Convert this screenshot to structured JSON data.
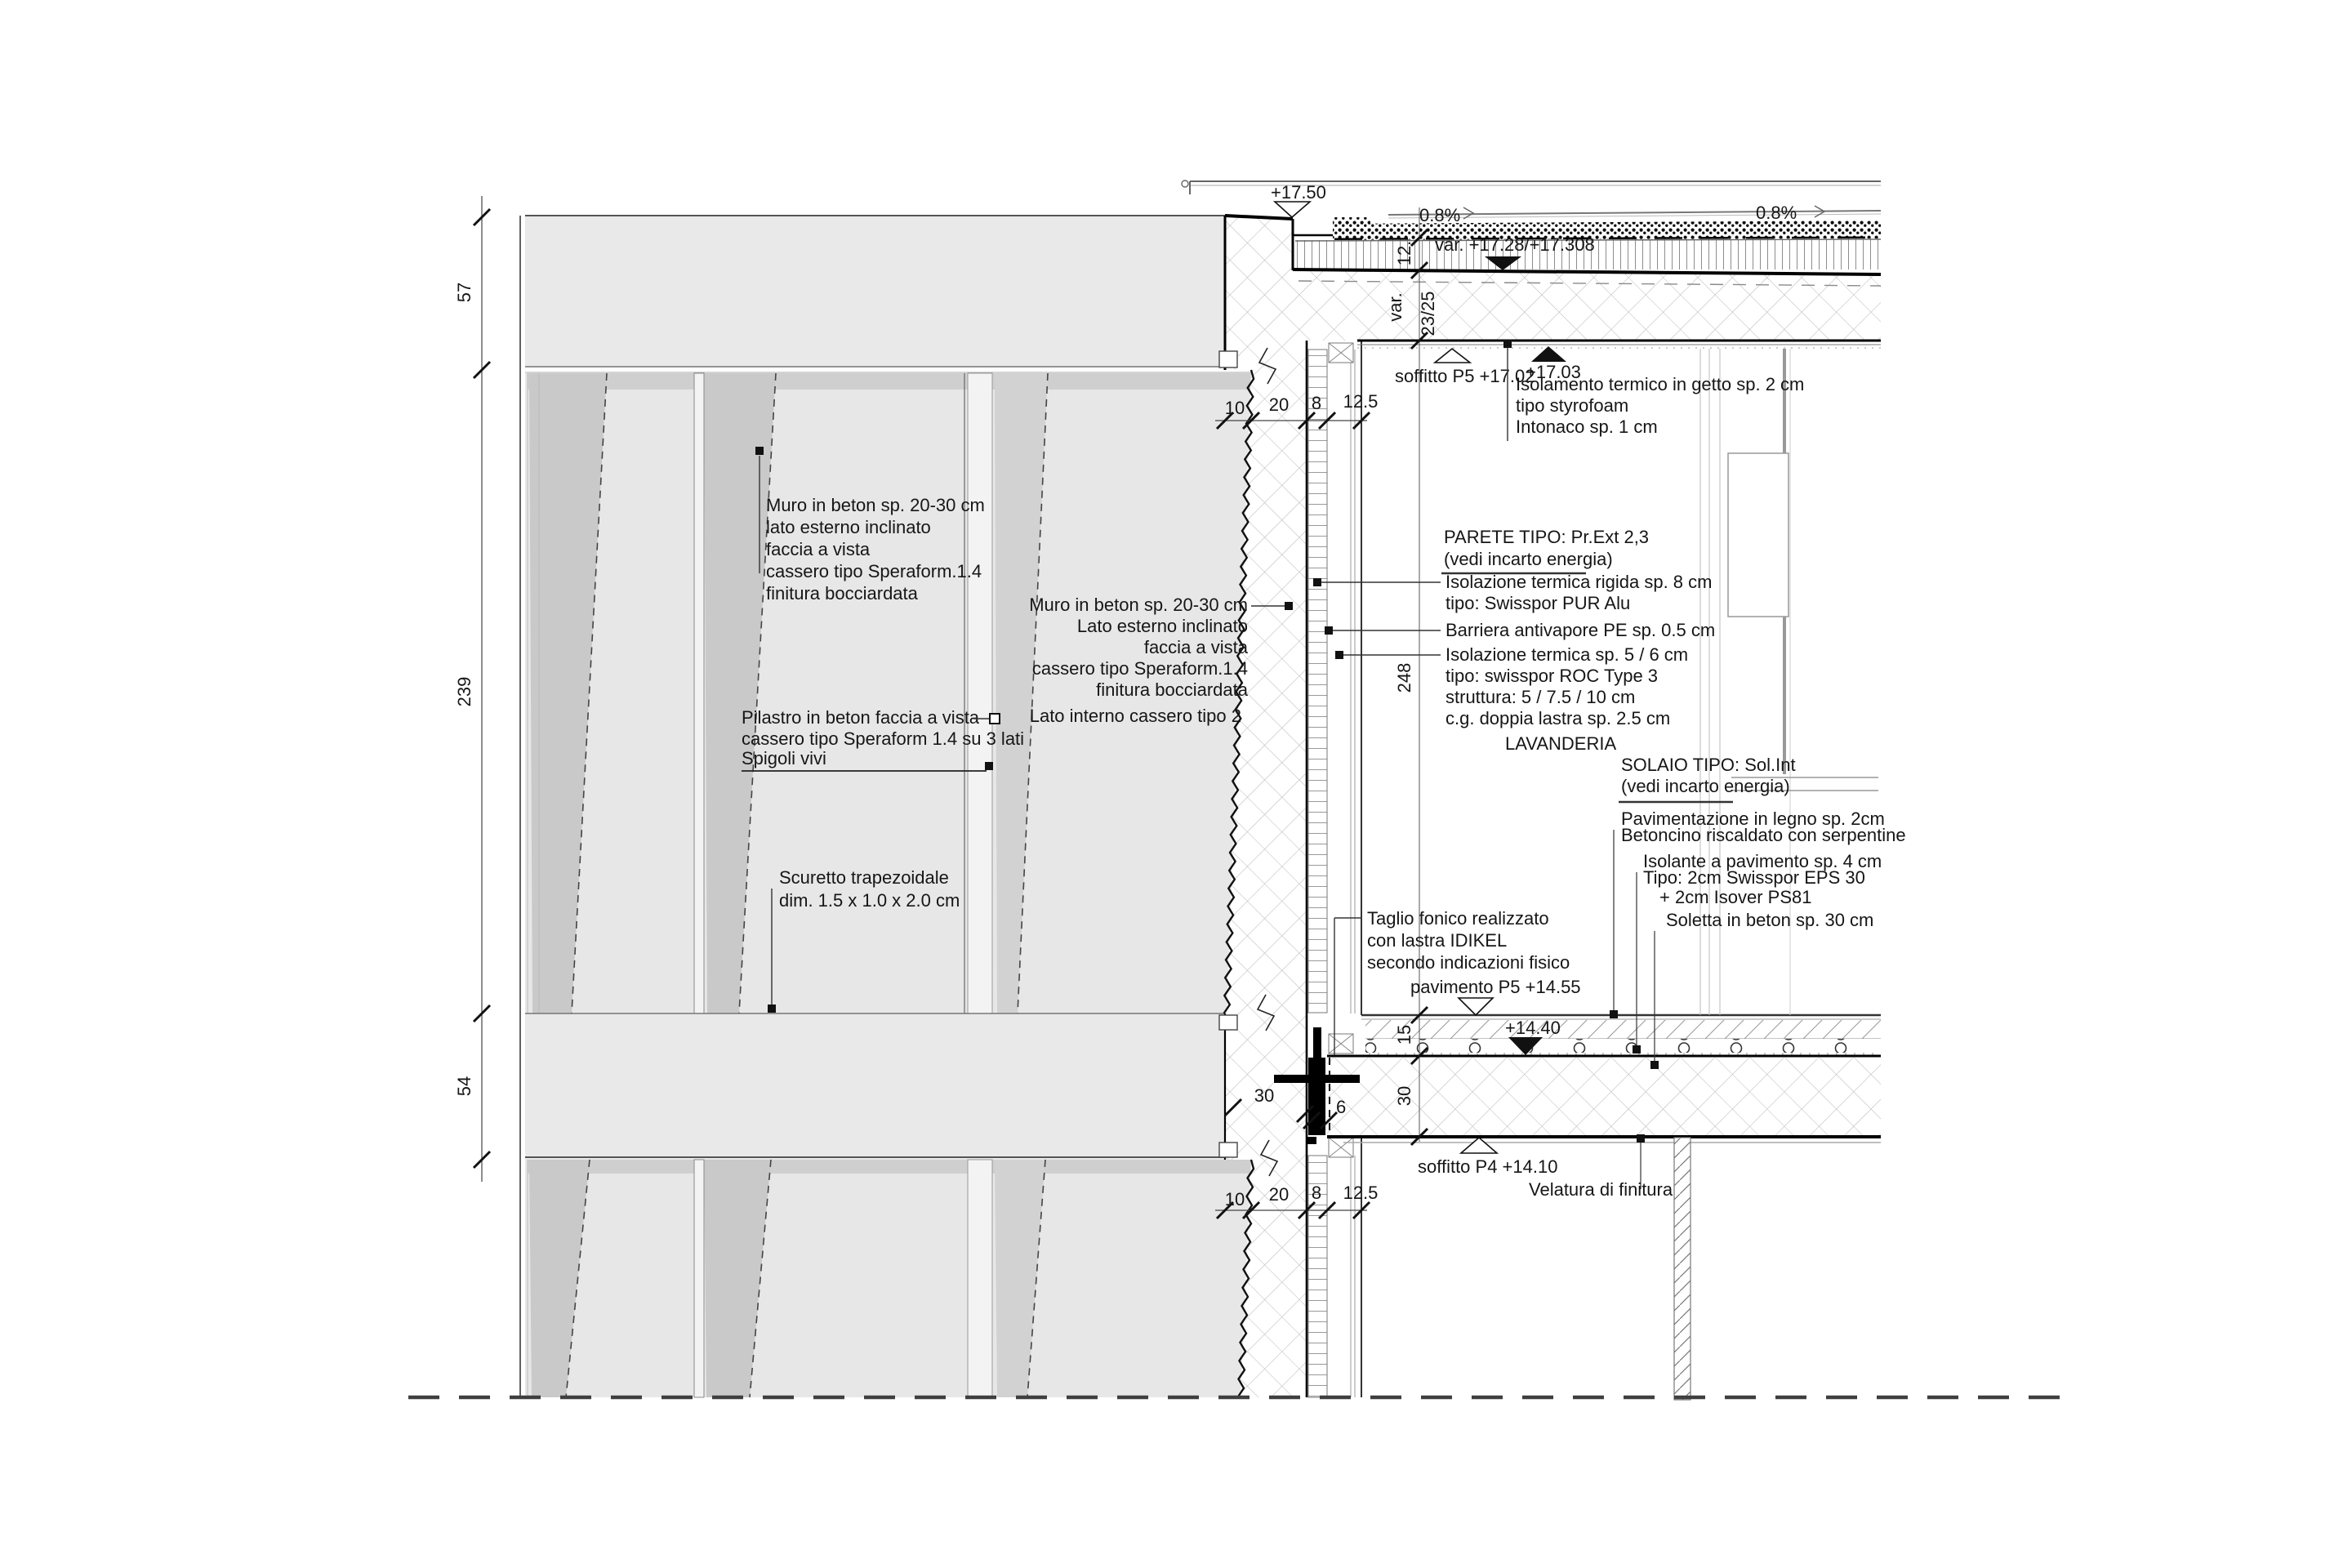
{
  "colors": {
    "panel": "#e7e7e7",
    "band": "#e9e9e9",
    "wedge": "#c9c9c9",
    "wedge_light": "#d2d2d2",
    "shadow": "#cfcfcf",
    "joint": "#f3f3f3",
    "ink": "#161616",
    "line_gray": "#8a8a8a"
  },
  "levels": {
    "top": "+17.50",
    "var_roof": "var. +17.28/+17.308",
    "soffitto_p5": "soffitto P5 +17.02",
    "iso_top": "+17.03",
    "pavimento_p5": "pavimento P5 +14.55",
    "slab_top": "+14.40",
    "soffitto_p4": "soffitto P4 +14.10"
  },
  "slopes": {
    "left": "0.8%",
    "right": "0.8%"
  },
  "dims": {
    "left": [
      "57",
      "239",
      "54"
    ],
    "chain": [
      "10",
      "20",
      "8",
      "12.5"
    ],
    "vchain": {
      "d12": "12.",
      "dvar": "var.",
      "d2325": "23/25",
      "d248": "248",
      "d15": "15",
      "d30": "30"
    },
    "junction": {
      "wall": "30",
      "gap": "6"
    }
  },
  "blocks": {
    "muro1": {
      "lines": [
        "Muro in beton sp. 20-30 cm",
        "lato esterno inclinato",
        "faccia a vista",
        "cassero tipo Speraform.1.4",
        "finitura bocciardata"
      ]
    },
    "muro2": {
      "lines": [
        "Muro in beton sp. 20-30 cm",
        "Lato esterno inclinato",
        "faccia a vista",
        "cassero tipo Speraform.1.4",
        "finitura bocciardata"
      ]
    },
    "lato_interno": "Lato interno cassero tipo 2",
    "pilastro": {
      "lines": [
        "Pilastro in beton faccia a vista",
        "cassero tipo Speraform 1.4 su 3 lati",
        "Spigoli vivi"
      ]
    },
    "scuretto": {
      "lines": [
        "Scuretto trapezoidale",
        "dim.    1.5 x 1.0 x 2.0 cm"
      ]
    },
    "taglio": {
      "lines": [
        "Taglio fonico realizzato",
        "con lastra IDIKEL",
        "secondo indicazioni fisico"
      ]
    },
    "isolamento": {
      "lines": [
        "Isolamento termico in getto sp. 2 cm",
        "tipo styrofoam",
        "Intonaco sp. 1 cm"
      ]
    },
    "parete": {
      "title": "PARETE TIPO: Pr.Ext 2,3",
      "subtitle": "(vedi incarto energia)",
      "item1": [
        "Isolazione termica rigida sp. 8 cm",
        "tipo: Swisspor PUR Alu"
      ],
      "item2": [
        "Barriera antivapore PE sp. 0.5 cm"
      ],
      "item3": [
        "Isolazione termica sp. 5 / 6 cm",
        "tipo:   swisspor ROC Type 3",
        "struttura: 5 / 7.5 / 10 cm",
        "c.g. doppia lastra sp. 2.5 cm"
      ]
    },
    "solaio": {
      "title": "SOLAIO TIPO: Sol.Int",
      "subtitle": "(vedi incarto energia)",
      "item1": [
        "Pavimentazione in legno sp. 2cm",
        "Betoncino riscaldato con serpentine"
      ],
      "item2": [
        "Isolante a pavimento  sp. 4 cm",
        "Tipo: 2cm Swisspor EPS 30",
        "+ 2cm Isover PS81"
      ],
      "item3": [
        "Soletta in beton sp. 30 cm"
      ]
    },
    "room": "LAVANDERIA",
    "velatura": "Velatura di finitura"
  }
}
